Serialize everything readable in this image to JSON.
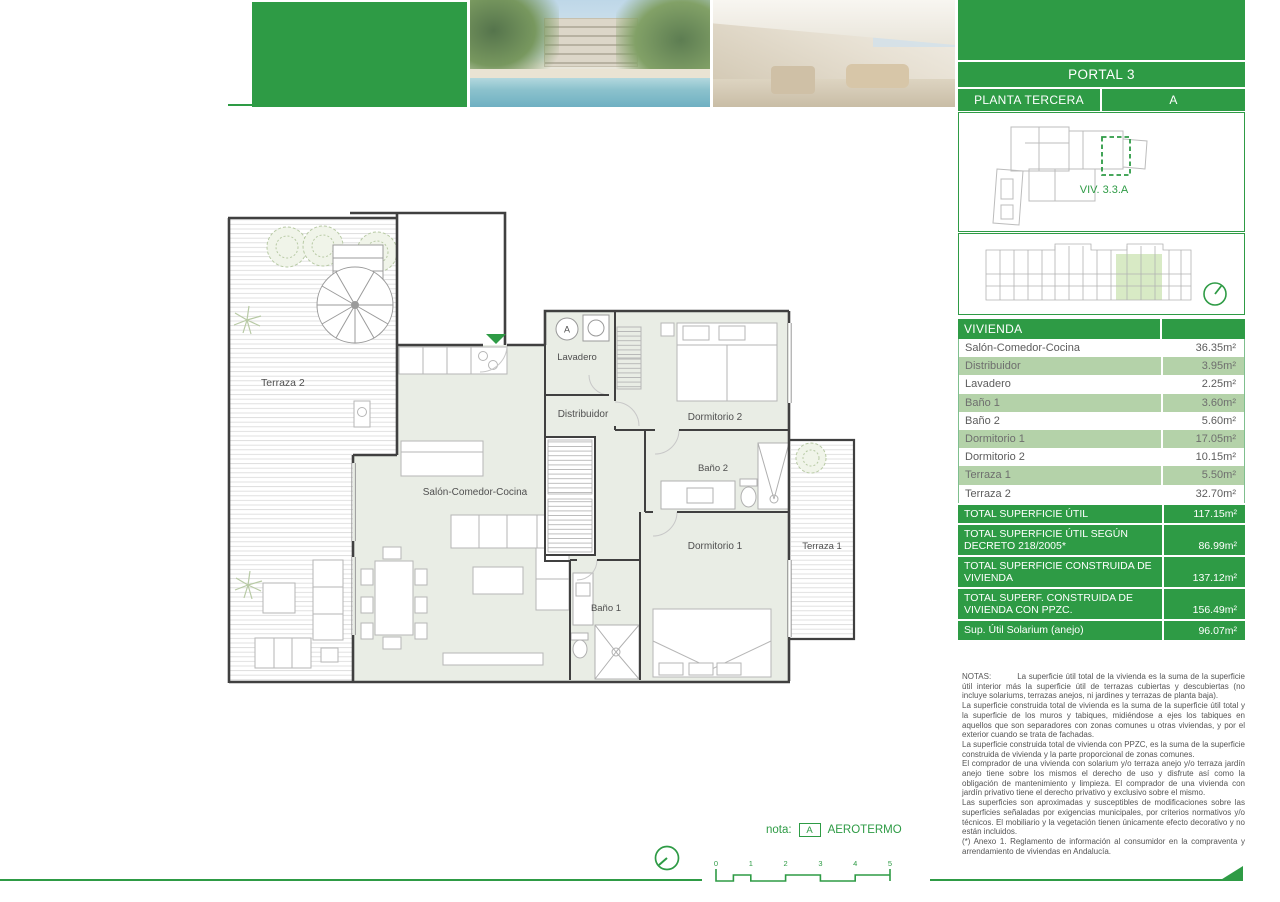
{
  "header": {
    "portal": "PORTAL 3",
    "planta": "PLANTA TERCERA",
    "letter": "A",
    "unit_code": "VIV. 3.3.A"
  },
  "vivienda_table": {
    "title": "VIVIENDA",
    "rows": [
      {
        "label": "Salón-Comedor-Cocina",
        "value": "36.35m²"
      },
      {
        "label": "Distribuidor",
        "value": "3.95m²"
      },
      {
        "label": "Lavadero",
        "value": "2.25m²"
      },
      {
        "label": "Baño 1",
        "value": "3.60m²"
      },
      {
        "label": "Baño 2",
        "value": "5.60m²"
      },
      {
        "label": "Dormitorio 1",
        "value": "17.05m²"
      },
      {
        "label": "Dormitorio 2",
        "value": "10.15m²"
      },
      {
        "label": "Terraza 1",
        "value": "5.50m²"
      },
      {
        "label": "Terraza 2",
        "value": "32.70m²"
      }
    ],
    "totals": [
      {
        "label": "TOTAL SUPERFICIE ÚTIL",
        "value": "117.15m²"
      },
      {
        "label": "TOTAL SUPERFICIE ÚTIL SEGÚN DECRETO 218/2005*",
        "value": "86.99m²"
      },
      {
        "label": "TOTAL SUPERFICIE CONSTRUIDA DE VIVIENDA",
        "value": "137.12m²"
      },
      {
        "label": "TOTAL SUPERF. CONSTRUIDA DE VIVIENDA CON PPZC.",
        "value": "156.49m²"
      },
      {
        "label": "Sup. Útil Solarium (anejo)",
        "value": "96.07m²"
      }
    ]
  },
  "plan": {
    "rooms": {
      "salon": "Salón-Comedor-Cocina",
      "distribuidor": "Distribuidor",
      "lavadero": "Lavadero",
      "dormitorio2": "Dormitorio 2",
      "bano2": "Baño 2",
      "dormitorio1": "Dormitorio 1",
      "bano1": "Baño 1",
      "terraza1": "Terraza 1",
      "terraza2": "Terraza 2"
    },
    "aerotermo_marker": "A"
  },
  "notes": {
    "label": "NOTAS:",
    "paragraphs": [
      "La superficie útil total de la vivienda es la suma de la superficie útil interior más la superficie útil de terrazas cubiertas y descubiertas (no incluye solariums, terrazas anejos, ni jardines y terrazas de planta baja).",
      "La superficie construida total de vivienda es la suma de la superficie útil total y la superficie de los muros y tabiques, midiéndose a ejes los tabiques en aquellos que son separadores con zonas comunes u otras viviendas, y por el exterior cuando se trata de fachadas.",
      "La superficie construida total de vivienda con PPZC, es la suma de la superficie construida de vivienda y la parte proporcional de zonas comunes.",
      "El comprador de una vivienda con solarium y/o terraza anejo y/o terraza jardín anejo tiene sobre los mismos el derecho de uso y disfrute así como la obligación de mantenimiento y limpieza. El comprador de una vivienda con jardín privativo tiene el derecho privativo y exclusivo sobre el mismo.",
      "Las superficies son aproximadas y susceptibles de modificaciones sobre las superficies señaladas por exigencias municipales, por criterios normativos y/o técnicos. El mobiliario y la vegetación tienen únicamente efecto decorativo y no están incluidos.",
      "(*) Anexo 1. Reglamento de información al consumidor en la compraventa y arrendamiento de viviendas en Andalucía."
    ]
  },
  "footer": {
    "nota_label": "nota:",
    "marker": "A",
    "marker_text": "AEROTERMO",
    "scale_ticks": [
      "0",
      "1",
      "2",
      "3",
      "4",
      "5"
    ]
  },
  "colors": {
    "brand_green": "#2e9b45",
    "row_green": "#b4d2a9",
    "highlight_green": "#d8eac5",
    "floor_fill": "#e9ede5"
  }
}
